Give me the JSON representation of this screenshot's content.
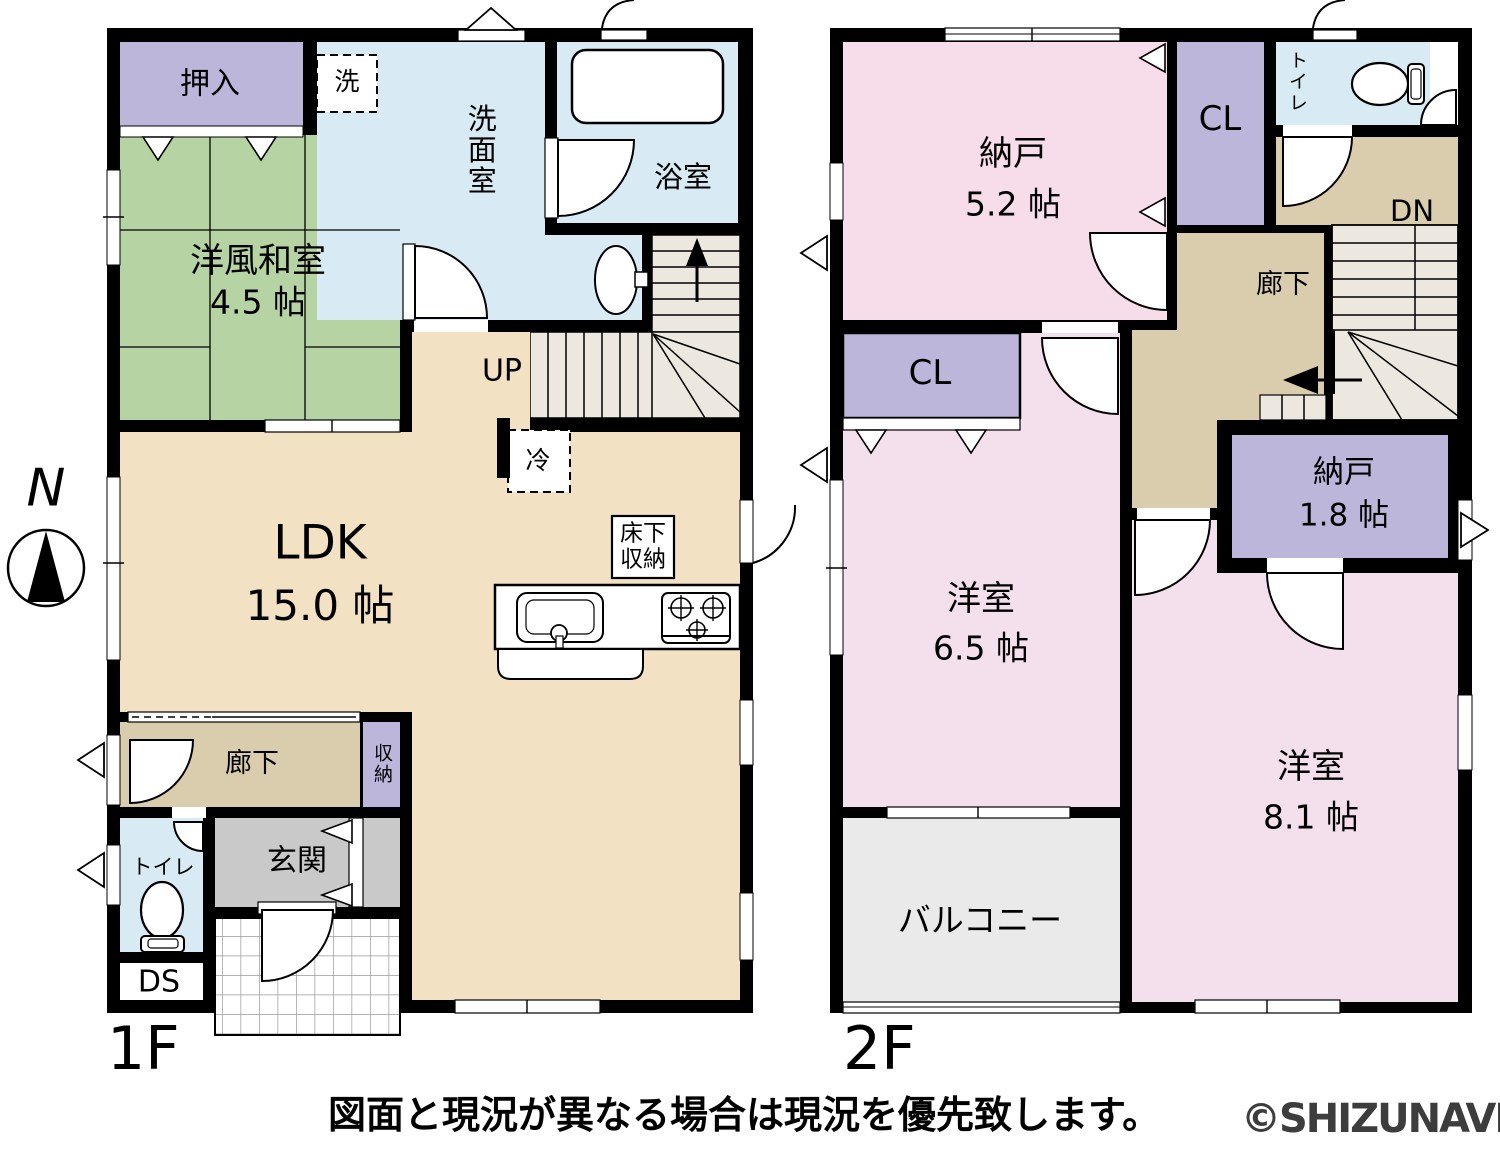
{
  "compass": {
    "label": "N"
  },
  "floors": {
    "f1": {
      "label": "1F",
      "rooms": {
        "oshiire": {
          "label": "押入"
        },
        "washitsu": {
          "name": "洋風和室",
          "size": "4.5 帖"
        },
        "sen": {
          "label": "洗"
        },
        "senmen": {
          "label": "洗面室"
        },
        "yokushitsu": {
          "label": "浴室"
        },
        "up": {
          "label": "UP"
        },
        "rei": {
          "label": "冷"
        },
        "ldk": {
          "name": "LDK",
          "size": "15.0 帖"
        },
        "yukashita": {
          "label": "床下収納"
        },
        "rouka": {
          "label": "廊下"
        },
        "shuno": {
          "label": "収納"
        },
        "genkan": {
          "label": "玄関"
        },
        "toilet": {
          "label": "トイレ"
        },
        "ds": {
          "label": "DS"
        }
      }
    },
    "f2": {
      "label": "2F",
      "rooms": {
        "nando52": {
          "name": "納戸",
          "size": "5.2 帖"
        },
        "cl_top": {
          "label": "CL"
        },
        "toilet": {
          "label": "トイレ"
        },
        "dn": {
          "label": "DN"
        },
        "rouka": {
          "label": "廊下"
        },
        "cl_left": {
          "label": "CL"
        },
        "nando18": {
          "name": "納戸",
          "size": "1.8 帖"
        },
        "yoshitsu65": {
          "name": "洋室",
          "size": "6.5 帖"
        },
        "yoshitsu81": {
          "name": "洋室",
          "size": "8.1 帖"
        },
        "balcony": {
          "label": "バルコニー"
        }
      }
    }
  },
  "footer": {
    "caption": "図面と現況が異なる場合は現況を優先致します。",
    "watermark": "©SHIZUNAVI"
  },
  "colors": {
    "wall": "#000000",
    "ldk": "#f3e1c4",
    "hall": "#d9cdae",
    "tatami": "#b6d3a4",
    "water": "#d8ebf5",
    "closet": "#bcb7da",
    "pink-a": "#f7dcea",
    "pink-b": "#f4dfec",
    "genkan": "#c9c9c9",
    "balcony": "#eaeaea",
    "stair": "#ece8df",
    "watermark": "#3d3d3d"
  }
}
